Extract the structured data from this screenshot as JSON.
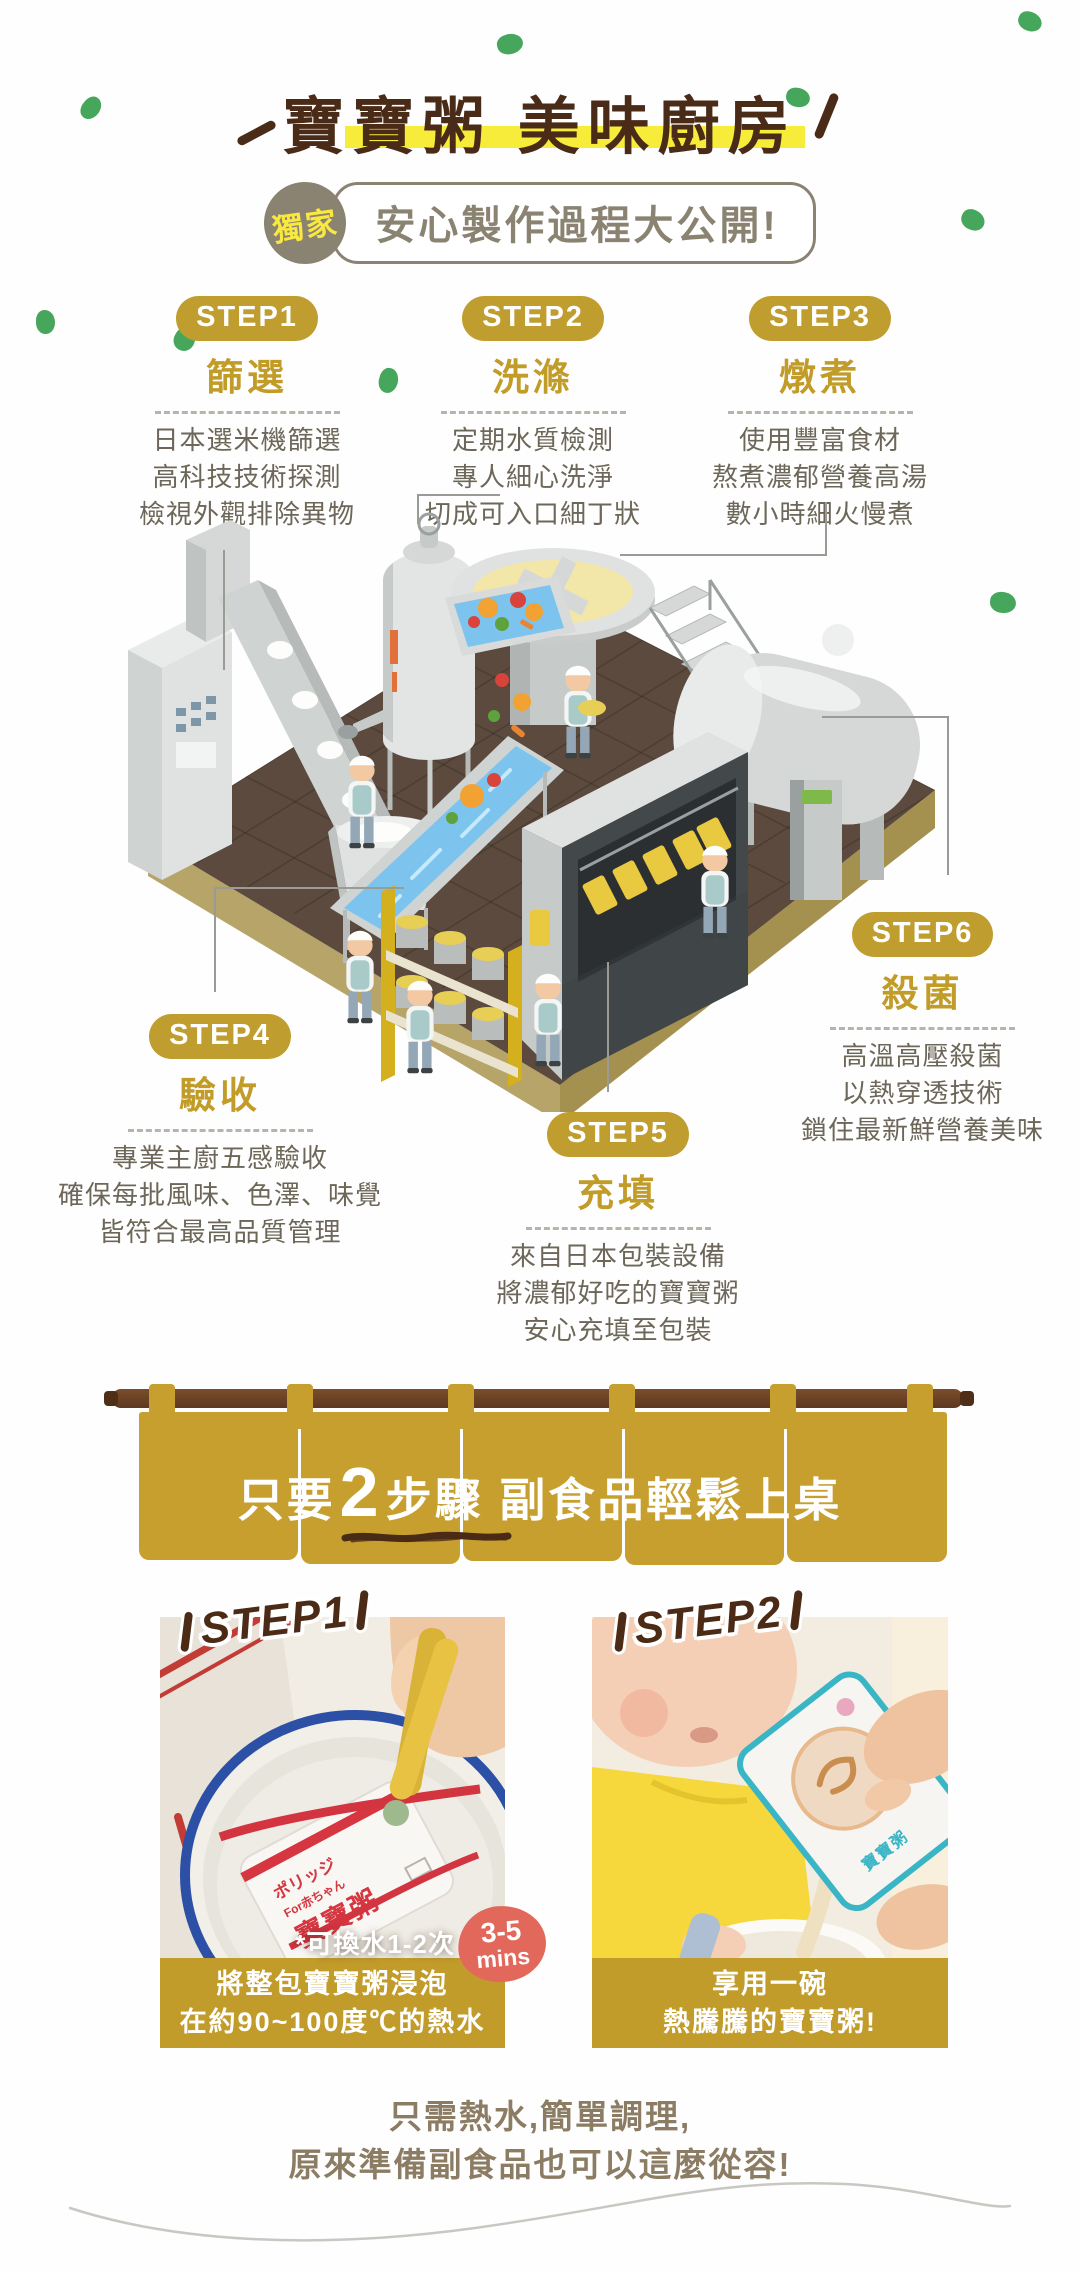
{
  "header": {
    "title": "寶寶粥 美味廚房",
    "badge": "獨家",
    "subtitle": "安心製作過程大公開!"
  },
  "steps": [
    {
      "badge": "STEP1",
      "name": "篩選",
      "lines": [
        "日本選米機篩選",
        "高科技技術探測",
        "檢視外觀排除異物"
      ]
    },
    {
      "badge": "STEP2",
      "name": "洗滌",
      "lines": [
        "定期水質檢測",
        "專人細心洗淨",
        "切成可入口細丁狀"
      ]
    },
    {
      "badge": "STEP3",
      "name": "燉煮",
      "lines": [
        "使用豐富食材",
        "熬煮濃郁營養高湯",
        "數小時細火慢煮"
      ]
    },
    {
      "badge": "STEP4",
      "name": "驗收",
      "lines": [
        "專業主廚五感驗收",
        "確保每批風味、色澤、味覺",
        "皆符合最高品質管理"
      ]
    },
    {
      "badge": "STEP5",
      "name": "充填",
      "lines": [
        "來自日本包裝設備",
        "將濃郁好吃的寶寶粥",
        "安心充填至包裝"
      ]
    },
    {
      "badge": "STEP6",
      "name": "殺菌",
      "lines": [
        "高溫高壓殺菌",
        "以熱穿透技術",
        "鎖住最新鮮營養美味"
      ]
    }
  ],
  "banner": {
    "pre": "只要",
    "num": "2",
    "mid": "步驟",
    "rest": " 副食品輕鬆上桌"
  },
  "photos": {
    "left": {
      "label": "STEP1",
      "note": "*可換水1-2次",
      "time_badge": {
        "line1": "3-5",
        "line2": "mins"
      },
      "caption": [
        "將整包寶寶粥浸泡",
        "在約90~100度℃的熱水"
      ],
      "package": {
        "brand": "ポリッジ",
        "sub": "For赤ちゃん",
        "name": "寶寶粥"
      }
    },
    "right": {
      "label": "STEP2",
      "caption": [
        "享用一碗",
        "熱騰騰的寶寶粥!"
      ],
      "package": {
        "name": "寶寶粥"
      }
    }
  },
  "footer": {
    "lines": [
      "只需熱水,簡單調理,",
      "原來準備副食品也可以這麼從容!"
    ]
  },
  "palette": {
    "gold_badge": "#bf9d2e",
    "gold_caption": "#c19c2a",
    "curtain": "#c79f2e",
    "title_brown": "#4a2b17",
    "body_text": "#6d6759",
    "olive": "#8a8372",
    "time_red": "#e2685c",
    "floor_top": "#5b4a3d",
    "floor_side": "#b5a266",
    "water_blue": "#7cc4ee",
    "highlight_yellow": "#f7ec3a",
    "speck_green": "#46a75c"
  }
}
